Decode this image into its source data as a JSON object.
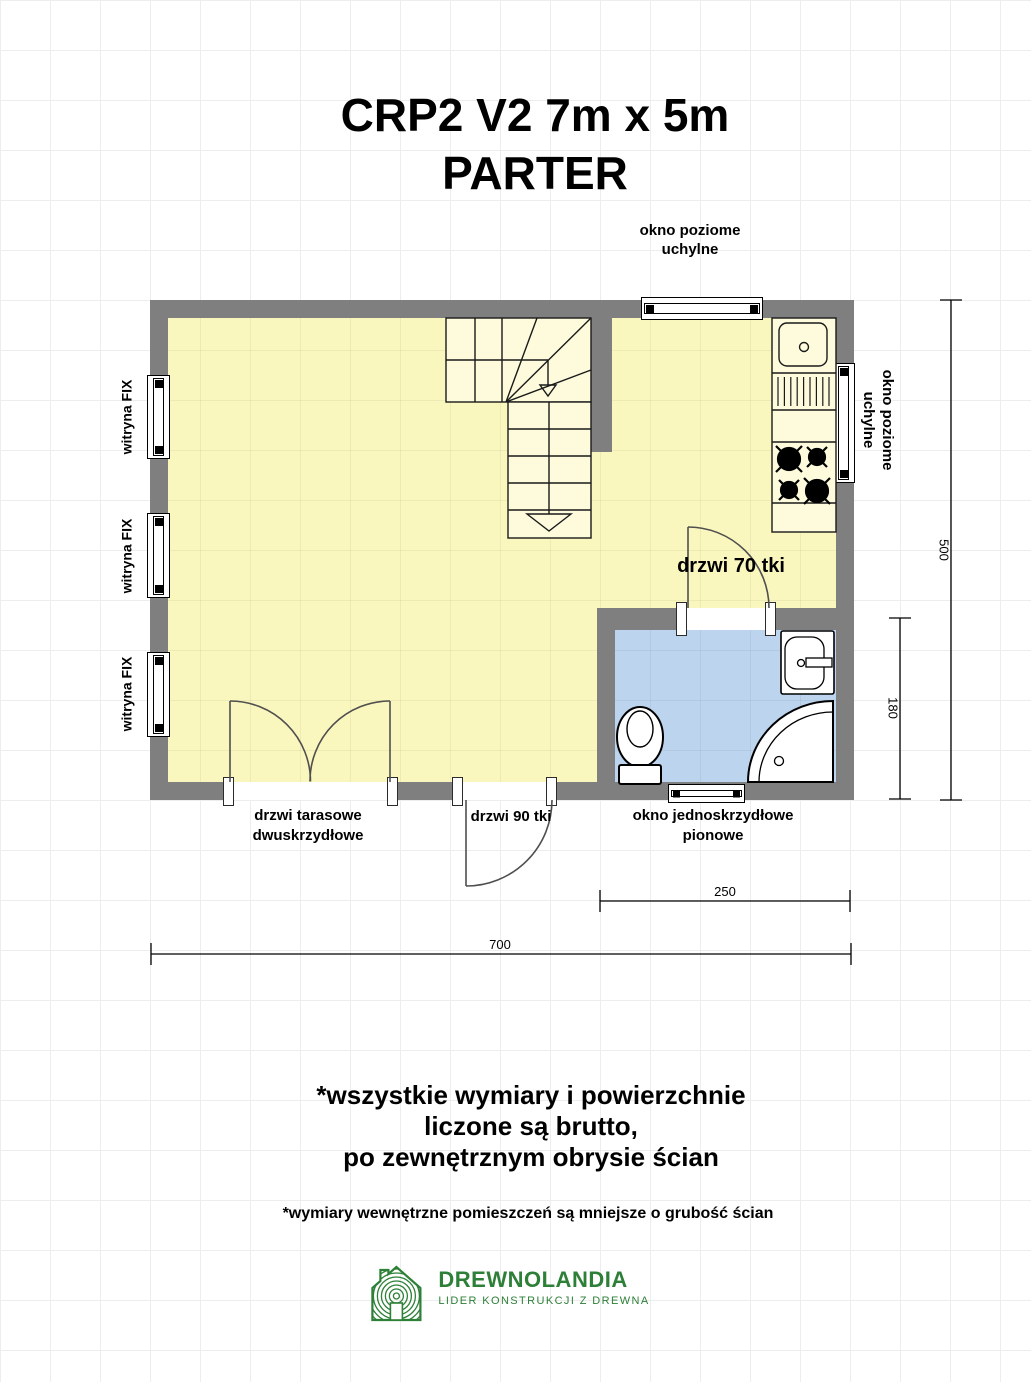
{
  "title": {
    "line1": "CRP2 V2 7m x 5m",
    "line2": "PARTER"
  },
  "plan": {
    "top_window_label": "okno poziome uchylne",
    "right_window_label_line1": "okno poziome",
    "right_window_label_line2": "uchylne",
    "left_window_labels": [
      "witryna FIX",
      "witryna FIX",
      "witryna FIX"
    ],
    "bathroom_door_label": "drzwi 70 tki",
    "terrace_door_label": "drzwi tarasowe dwuskrzydłowe",
    "entry_door_label": "drzwi 90 tki",
    "bathroom_window_label": "okno jednoskrzydłowe pionowe",
    "dimensions": {
      "total_height": "500",
      "bathroom_height": "180",
      "bathroom_width": "250",
      "total_width": "700"
    }
  },
  "notes": {
    "line1": "*wszystkie wymiary i powierzchnie",
    "line2": "liczone są brutto,",
    "line3": "po zewnętrznym obrysie ścian",
    "footnote": "*wymiary wewnętrzne pomieszczeń są mniejsze o grubość ścian"
  },
  "logo": {
    "name": "DREWNOLANDIA",
    "tagline": "LIDER KONSTRUKCJI Z DREWNA"
  },
  "colors": {
    "wall": "#7f7f7f",
    "room": "#faf7be",
    "bathroom": "#bdd4ee",
    "accent_green": "#2e8038"
  }
}
